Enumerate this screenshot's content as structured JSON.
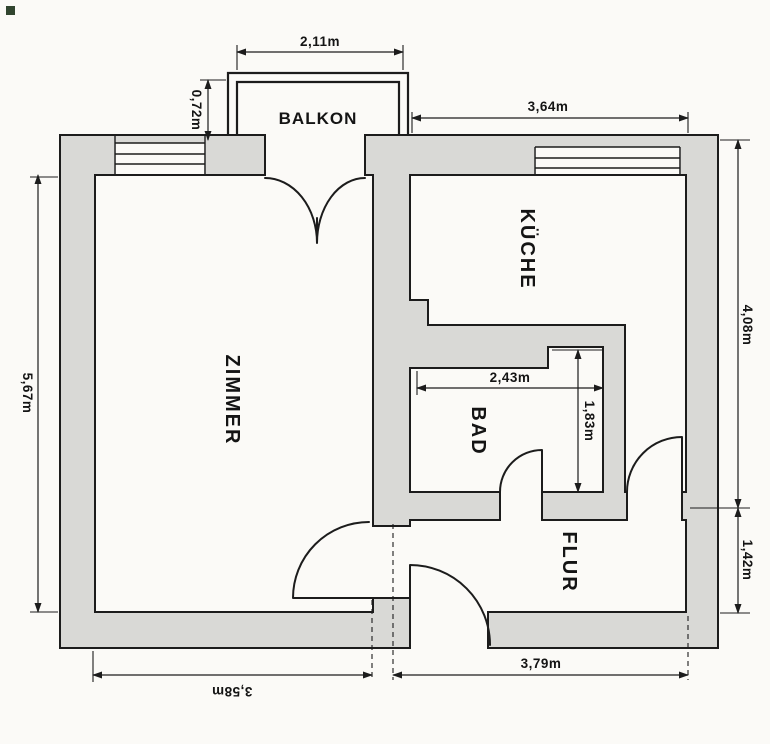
{
  "document": {
    "type": "apartment-floor-plan"
  },
  "colors": {
    "wall_fill": "#d9d9d6",
    "line": "#1c1c1c",
    "paper": "#fbfaf7",
    "mark": "#31452f"
  },
  "rooms": {
    "balkon": "BALKON",
    "zimmer": "ZIMMER",
    "kueche": "KÜCHE",
    "bad": "BAD",
    "flur": "FLUR"
  },
  "dims": {
    "balcony_width": "2,11m",
    "balcony_depth": "0,72m",
    "kitchen_width": "3,64m",
    "zimmer_height": "5,67m",
    "kitchen_height": "4,08m",
    "bad_width": "2,43m",
    "bad_height": "1,83m",
    "flur_height": "1,42m",
    "flur_width": "3,79m",
    "zimmer_width": "3,58m"
  }
}
